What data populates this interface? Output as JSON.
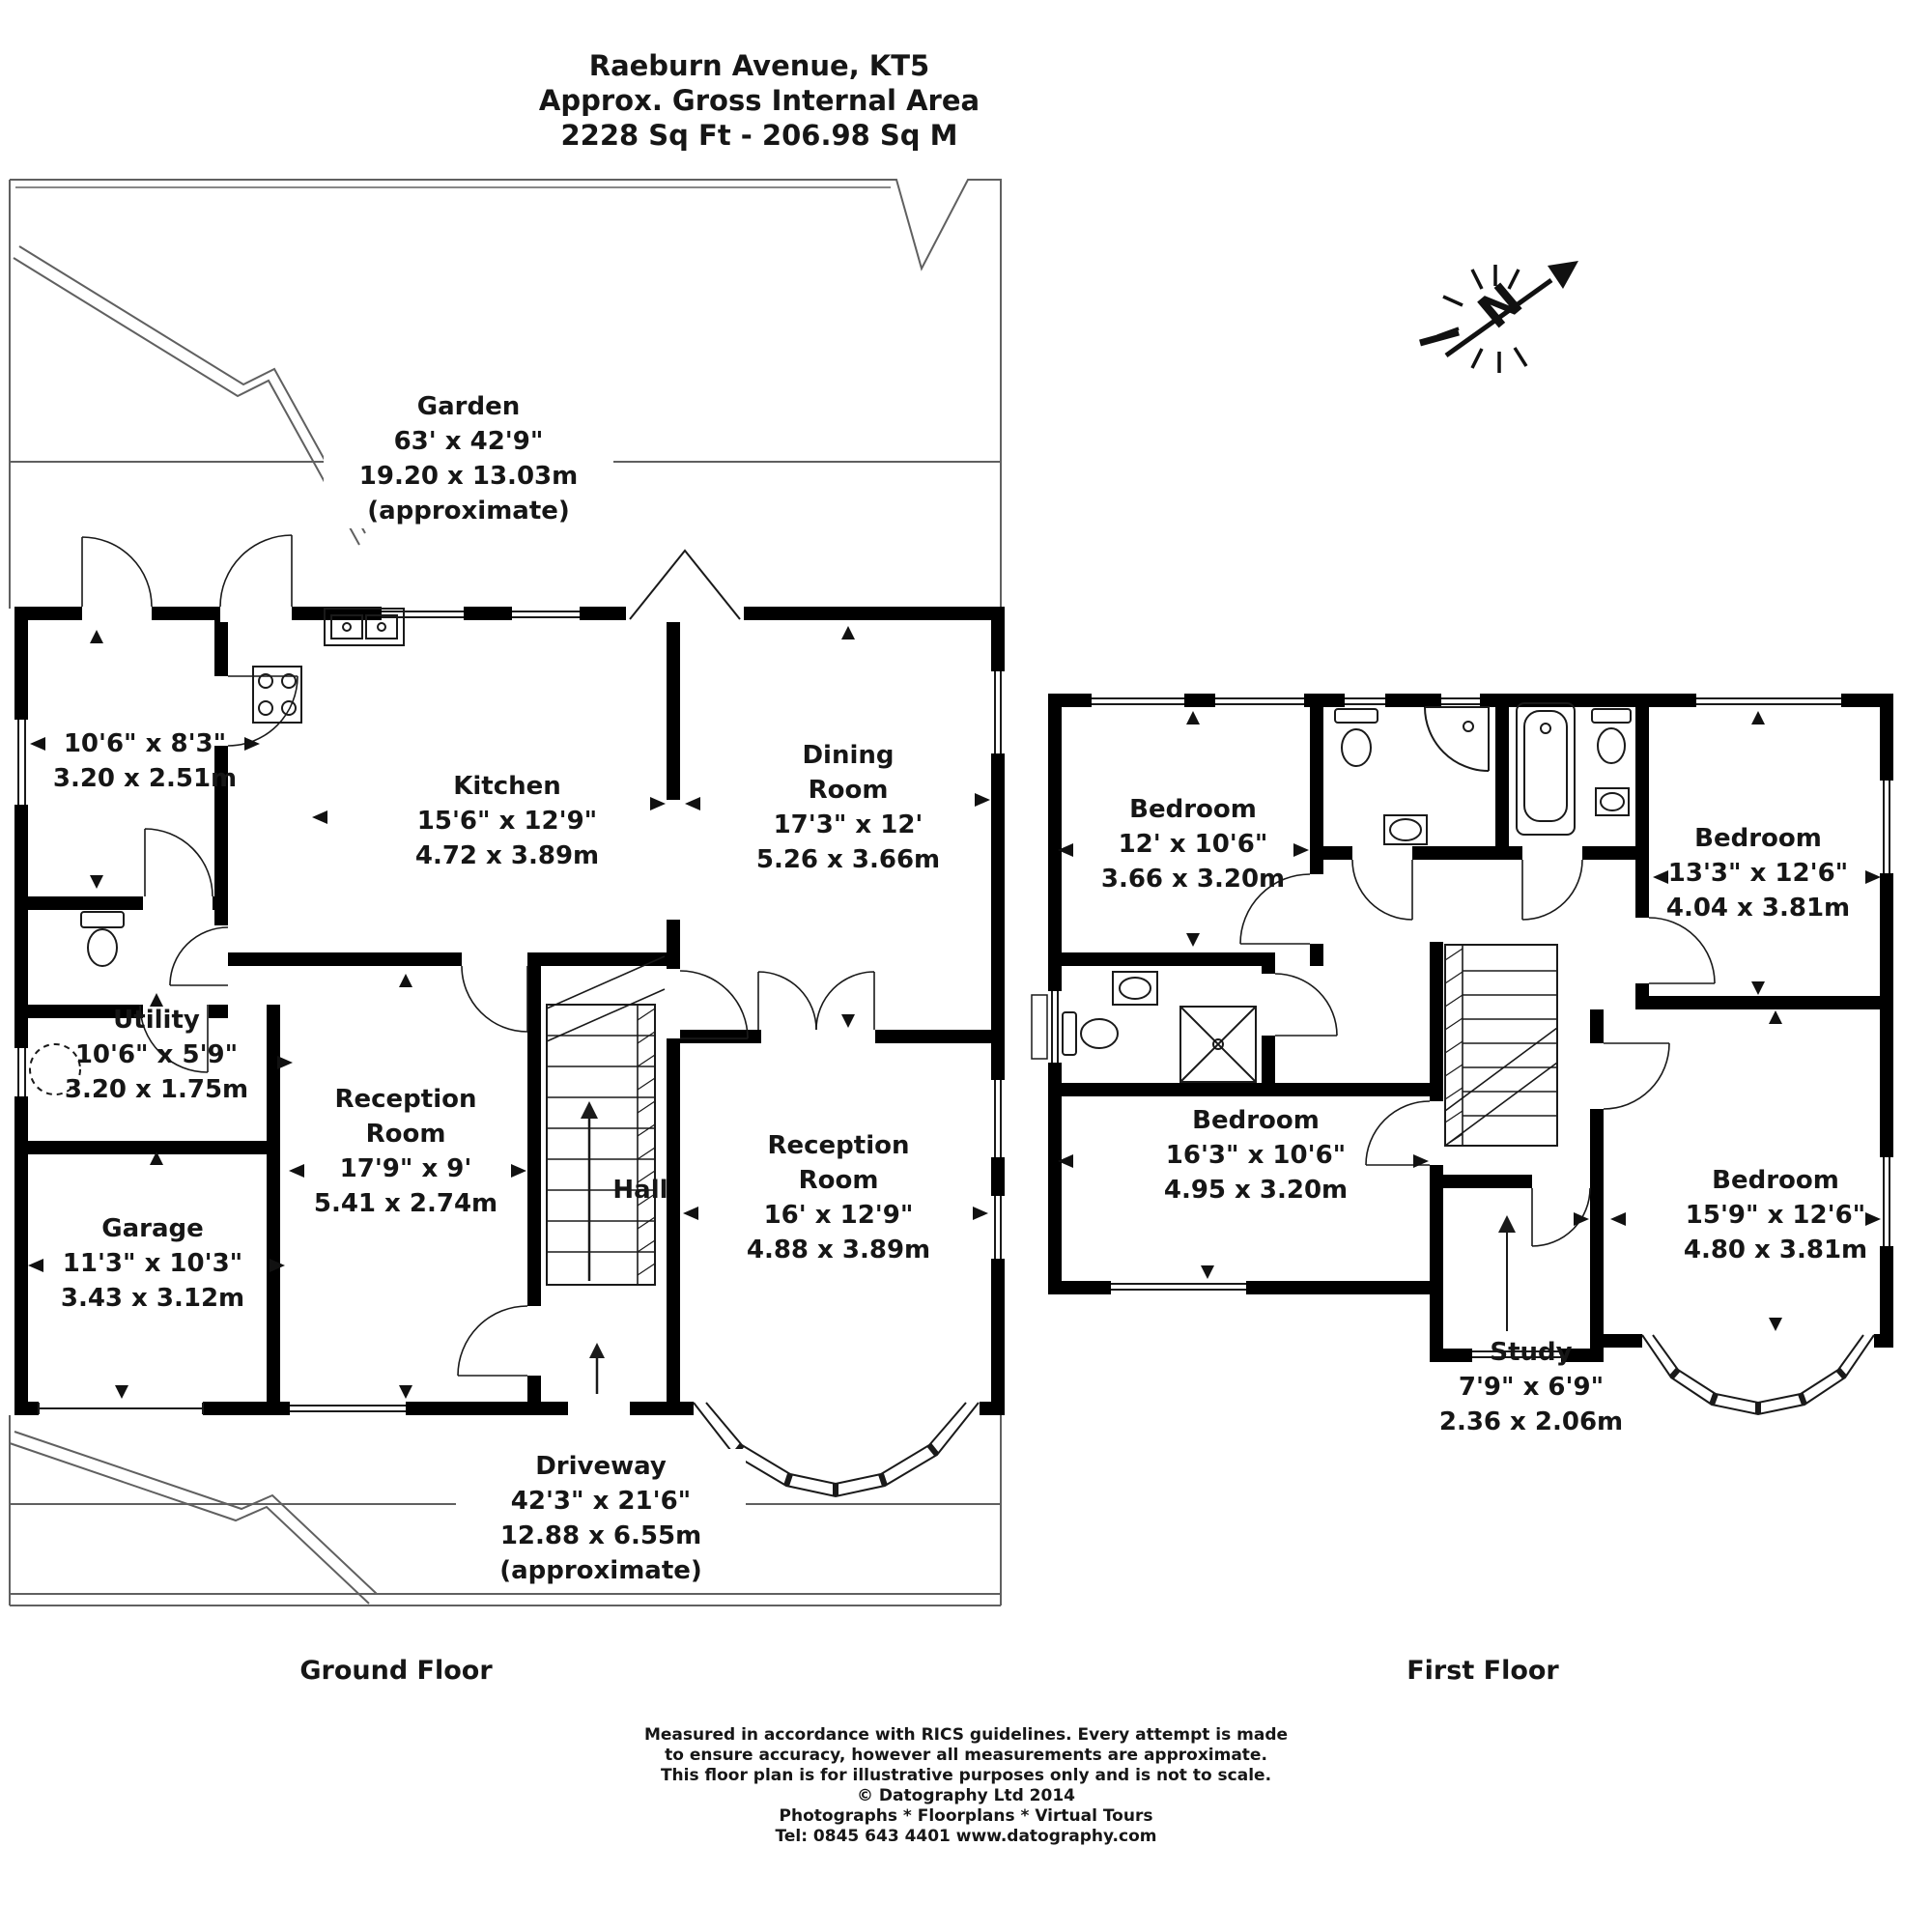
{
  "title": {
    "address": "Raeburn Avenue, KT5",
    "subtitle": "Approx. Gross Internal Area",
    "area": "2228 Sq Ft - 206.98 Sq M"
  },
  "north": {
    "letter": "N"
  },
  "colors": {
    "walls": "#000000",
    "lines": "#1a1a1a",
    "site_lines": "#606060",
    "text": "#161616",
    "background": "#ffffff"
  },
  "icons": {
    "north_arrow": "north-arrow-icon",
    "toilet": "toilet-icon",
    "bathtub": "bathtub-icon",
    "shower": "shower-icon",
    "basin": "basin-icon",
    "washing_machine": "washing-machine-icon",
    "sink": "sink-icon",
    "hob": "hob-icon",
    "stairs": "stairs-icon",
    "door": "door-arc",
    "window": "window",
    "bay_window": "bay-window",
    "entrance_arrow": "entrance-arrow"
  },
  "ground_floor": {
    "floor_label": "Ground Floor",
    "garden": {
      "name": "Garden",
      "imperial": "63' x 42'9\"",
      "metric": "19.20 x 13.03m",
      "note": "(approximate)"
    },
    "store_room": {
      "imperial": "10'6\" x 8'3\"",
      "metric": "3.20 x 2.51m"
    },
    "kitchen": {
      "name": "Kitchen",
      "imperial": "15'6\" x 12'9\"",
      "metric": "4.72 x 3.89m"
    },
    "dining_room": {
      "name": "Dining\nRoom",
      "imperial": "17'3\" x 12'",
      "metric": "5.26 x 3.66m"
    },
    "utility": {
      "name": "Utility",
      "imperial": "10'6\" x 5'9\"",
      "metric": "3.20 x 1.75m"
    },
    "reception_room_1": {
      "name": "Reception\nRoom",
      "imperial": "17'9\" x 9'",
      "metric": "5.41 x 2.74m"
    },
    "hall": {
      "name": "Hall"
    },
    "garage": {
      "name": "Garage",
      "imperial": "11'3\" x 10'3\"",
      "metric": "3.43 x 3.12m"
    },
    "reception_room_2": {
      "name": "Reception\nRoom",
      "imperial": "16' x 12'9\"",
      "metric": "4.88 x 3.89m"
    },
    "driveway": {
      "name": "Driveway",
      "imperial": "42'3\" x 21'6\"",
      "metric": "12.88 x 6.55m",
      "note": "(approximate)"
    }
  },
  "first_floor": {
    "floor_label": "First Floor",
    "bedroom_1": {
      "name": "Bedroom",
      "imperial": "12' x 10'6\"",
      "metric": "3.66 x 3.20m"
    },
    "bedroom_2": {
      "name": "Bedroom",
      "imperial": "13'3\" x 12'6\"",
      "metric": "4.04 x 3.81m"
    },
    "bedroom_3": {
      "name": "Bedroom",
      "imperial": "16'3\" x 10'6\"",
      "metric": "4.95 x 3.20m"
    },
    "bedroom_4": {
      "name": "Bedroom",
      "imperial": "15'9\" x 12'6\"",
      "metric": "4.80 x 3.81m"
    },
    "study": {
      "name": "Study",
      "imperial": "7'9\" x 6'9\"",
      "metric": "2.36 x 2.06m"
    }
  },
  "footer": {
    "lines": [
      "Measured in accordance with RICS guidelines. Every attempt is made",
      "to ensure accuracy, however all measurements are approximate.",
      "This floor plan is for illustrative purposes only and is not to scale.",
      "© Datography Ltd 2014",
      "Photographs * Floorplans * Virtual Tours",
      "Tel: 0845 643 4401 www.datography.com"
    ]
  }
}
